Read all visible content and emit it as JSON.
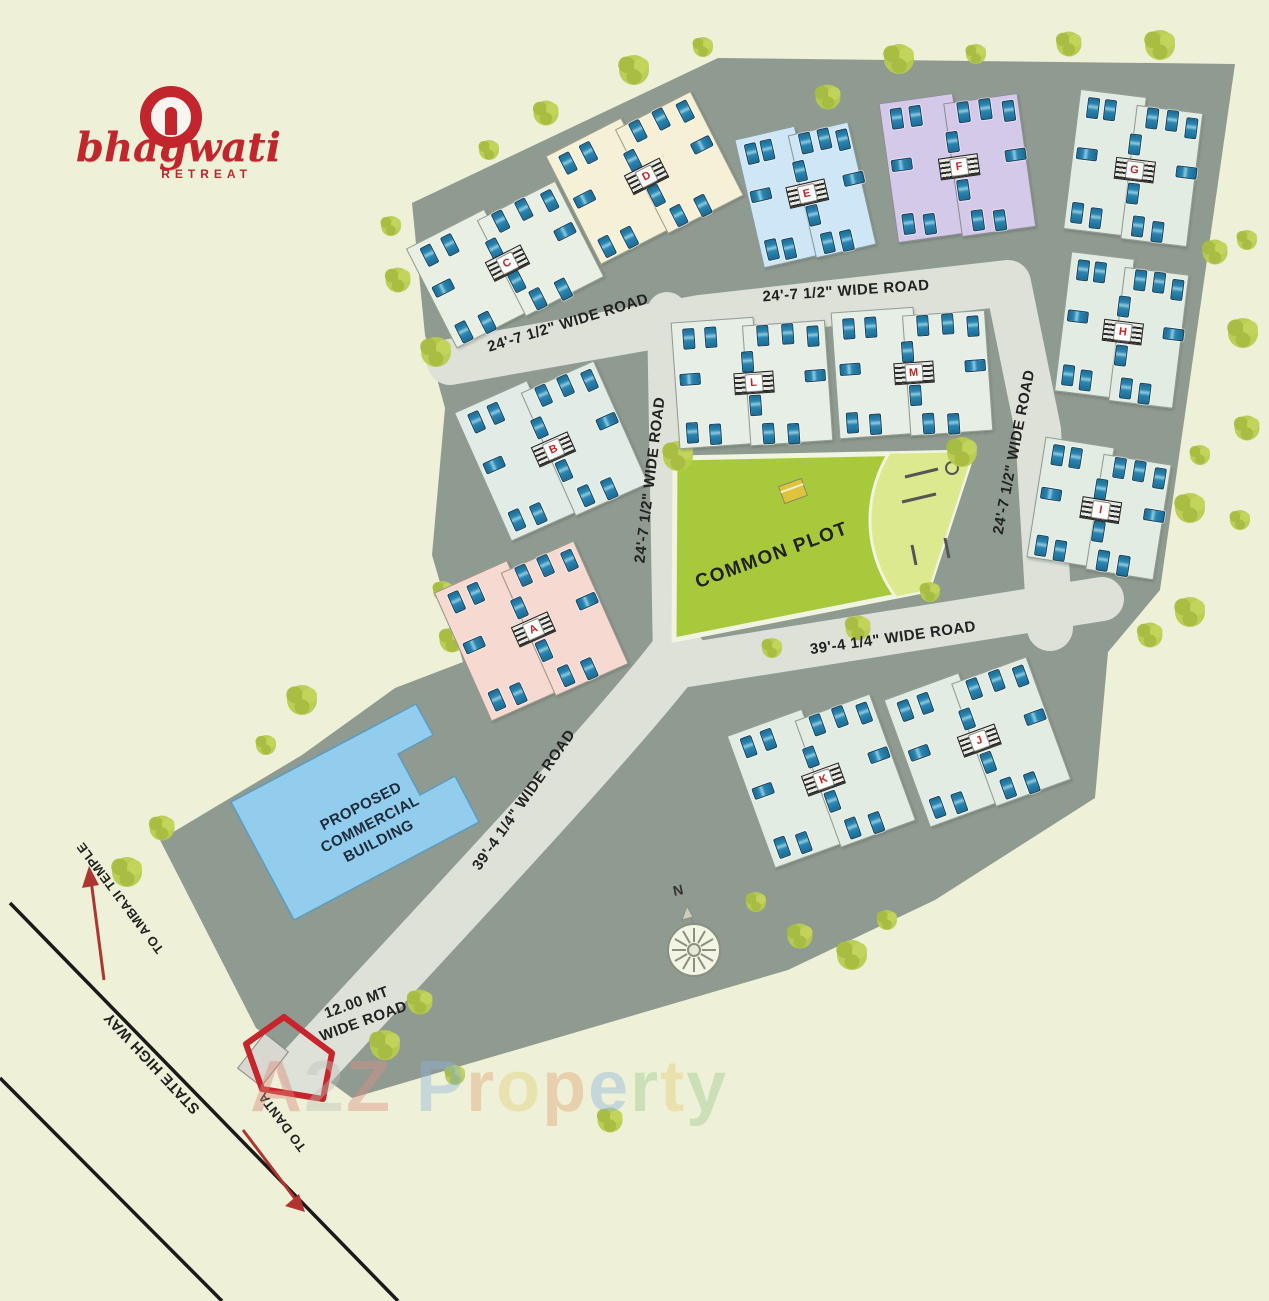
{
  "logo": {
    "name": "bhagwati",
    "tagline": "RETREAT"
  },
  "compass": {
    "north": "N"
  },
  "areas": {
    "common_plot": "COMMON PLOT",
    "commercial_building": "PROPOSED\nCOMMERCIAL\nBUILDING"
  },
  "roads": {
    "top_left": "24'-7 1/2\"  WIDE ROAD",
    "top_center": "24'-7 1/2\"  WIDE ROAD",
    "middle_vertical": "24'-7 1/2\" WIDE ROAD",
    "right_vertical": "24'-7 1/2\" WIDE ROAD",
    "below_common_plot": "39'-4 1/4\"  WIDE ROAD",
    "entrance_diagonal": "39'-4 1/4\"  WIDE ROAD",
    "entrance_main": "12.00 MT\nWIDE ROAD",
    "state_highway": "STATE HIGH WAY",
    "to_ambaji": "TO AMBAJI TEMPLE",
    "to_danta": "TO DANTA"
  },
  "buildings": [
    {
      "label": "A",
      "color": "#f6dad1"
    },
    {
      "label": "B",
      "color": "#e2ece6"
    },
    {
      "label": "C",
      "color": "#e9efe2"
    },
    {
      "label": "D",
      "color": "#f6f0d6"
    },
    {
      "label": "E",
      "color": "#cfe6f6"
    },
    {
      "label": "F",
      "color": "#d5c9ea"
    },
    {
      "label": "G",
      "color": "#e2ece3"
    },
    {
      "label": "H",
      "color": "#e2ece3"
    },
    {
      "label": "I",
      "color": "#e2ece3"
    },
    {
      "label": "J",
      "color": "#e2ece3"
    },
    {
      "label": "K",
      "color": "#e2ece3"
    },
    {
      "label": "L",
      "color": "#e6eee5"
    },
    {
      "label": "M",
      "color": "#e6eee5"
    }
  ],
  "watermark": {
    "text": "A2Z Property",
    "letters": [
      {
        "ch": "A",
        "color": "#d9897a"
      },
      {
        "ch": "2",
        "color": "#bcc0b8"
      },
      {
        "ch": "Z",
        "color": "#db8f85"
      },
      {
        "ch": " ",
        "color": "#000000"
      },
      {
        "ch": "P",
        "color": "#8fb4dc"
      },
      {
        "ch": "r",
        "color": "#e2a476"
      },
      {
        "ch": "o",
        "color": "#e3cf78"
      },
      {
        "ch": "p",
        "color": "#e2a476"
      },
      {
        "ch": "e",
        "color": "#8fb4dc"
      },
      {
        "ch": "r",
        "color": "#9cca8e"
      },
      {
        "ch": "t",
        "color": "#e3cf78"
      },
      {
        "ch": "y",
        "color": "#9cca8e"
      }
    ]
  },
  "colors": {
    "background": "#eef1d7",
    "site_area": "#8f9a90",
    "road": "#dde1d8",
    "common_plot": "#a9c93c",
    "common_plot_light": "#dce98e",
    "commercial_building": "#93cdee",
    "brand_red": "#c2252b",
    "building_label_red": "#c32525",
    "car_blue": "#2a85b2",
    "tree_green": "#b7cb4f"
  }
}
